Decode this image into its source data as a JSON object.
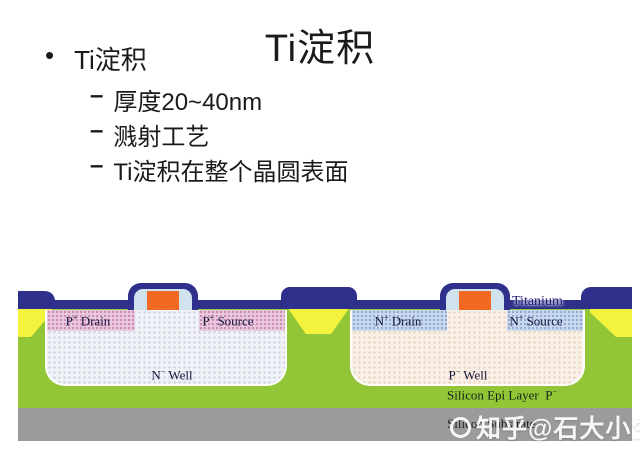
{
  "slide": {
    "title": "Ti淀积",
    "bullet": {
      "marker": "•",
      "label": "Ti淀积"
    },
    "sub_bullets": [
      {
        "marker": "–",
        "label": "厚度20~40nm"
      },
      {
        "marker": "–",
        "label": "溅射工艺"
      },
      {
        "marker": "–",
        "label": "Ti淀积在整个晶圆表面"
      }
    ]
  },
  "diagram": {
    "labels": {
      "titanium": "Titanium",
      "p_drain": {
        "base": "P",
        "sup": "+",
        "rest": " Drain"
      },
      "p_source": {
        "base": "P",
        "sup": "+",
        "rest": " Source"
      },
      "n_drain": {
        "base": "N",
        "sup": "+",
        "rest": " Drain"
      },
      "n_source": {
        "base": "N",
        "sup": "+",
        "rest": " Source"
      },
      "n_well": {
        "base": "N",
        "sup": "−",
        "rest": " Well"
      },
      "p_well": {
        "base": "P",
        "sup": "−",
        "rest": " Well"
      },
      "epi": {
        "base": "Silicon Epi Layer  P",
        "sup": "−",
        "rest": ""
      },
      "substrate": "Silicon Substrate"
    },
    "colors": {
      "titanium": "#2f2f8c",
      "gate_poly": "#f26a22",
      "field_oxide": "#f3f33e",
      "epi_layer": "#92c636",
      "substrate": "#9b9b9b",
      "p_plus": "#e9c7dc",
      "n_plus": "#c9d9ec",
      "n_well_fill": "#f0f2f7",
      "p_well_fill": "#f9f0e7",
      "spacer": "#cfe2ee"
    }
  },
  "watermark": {
    "text": "知乎@石大小生"
  }
}
